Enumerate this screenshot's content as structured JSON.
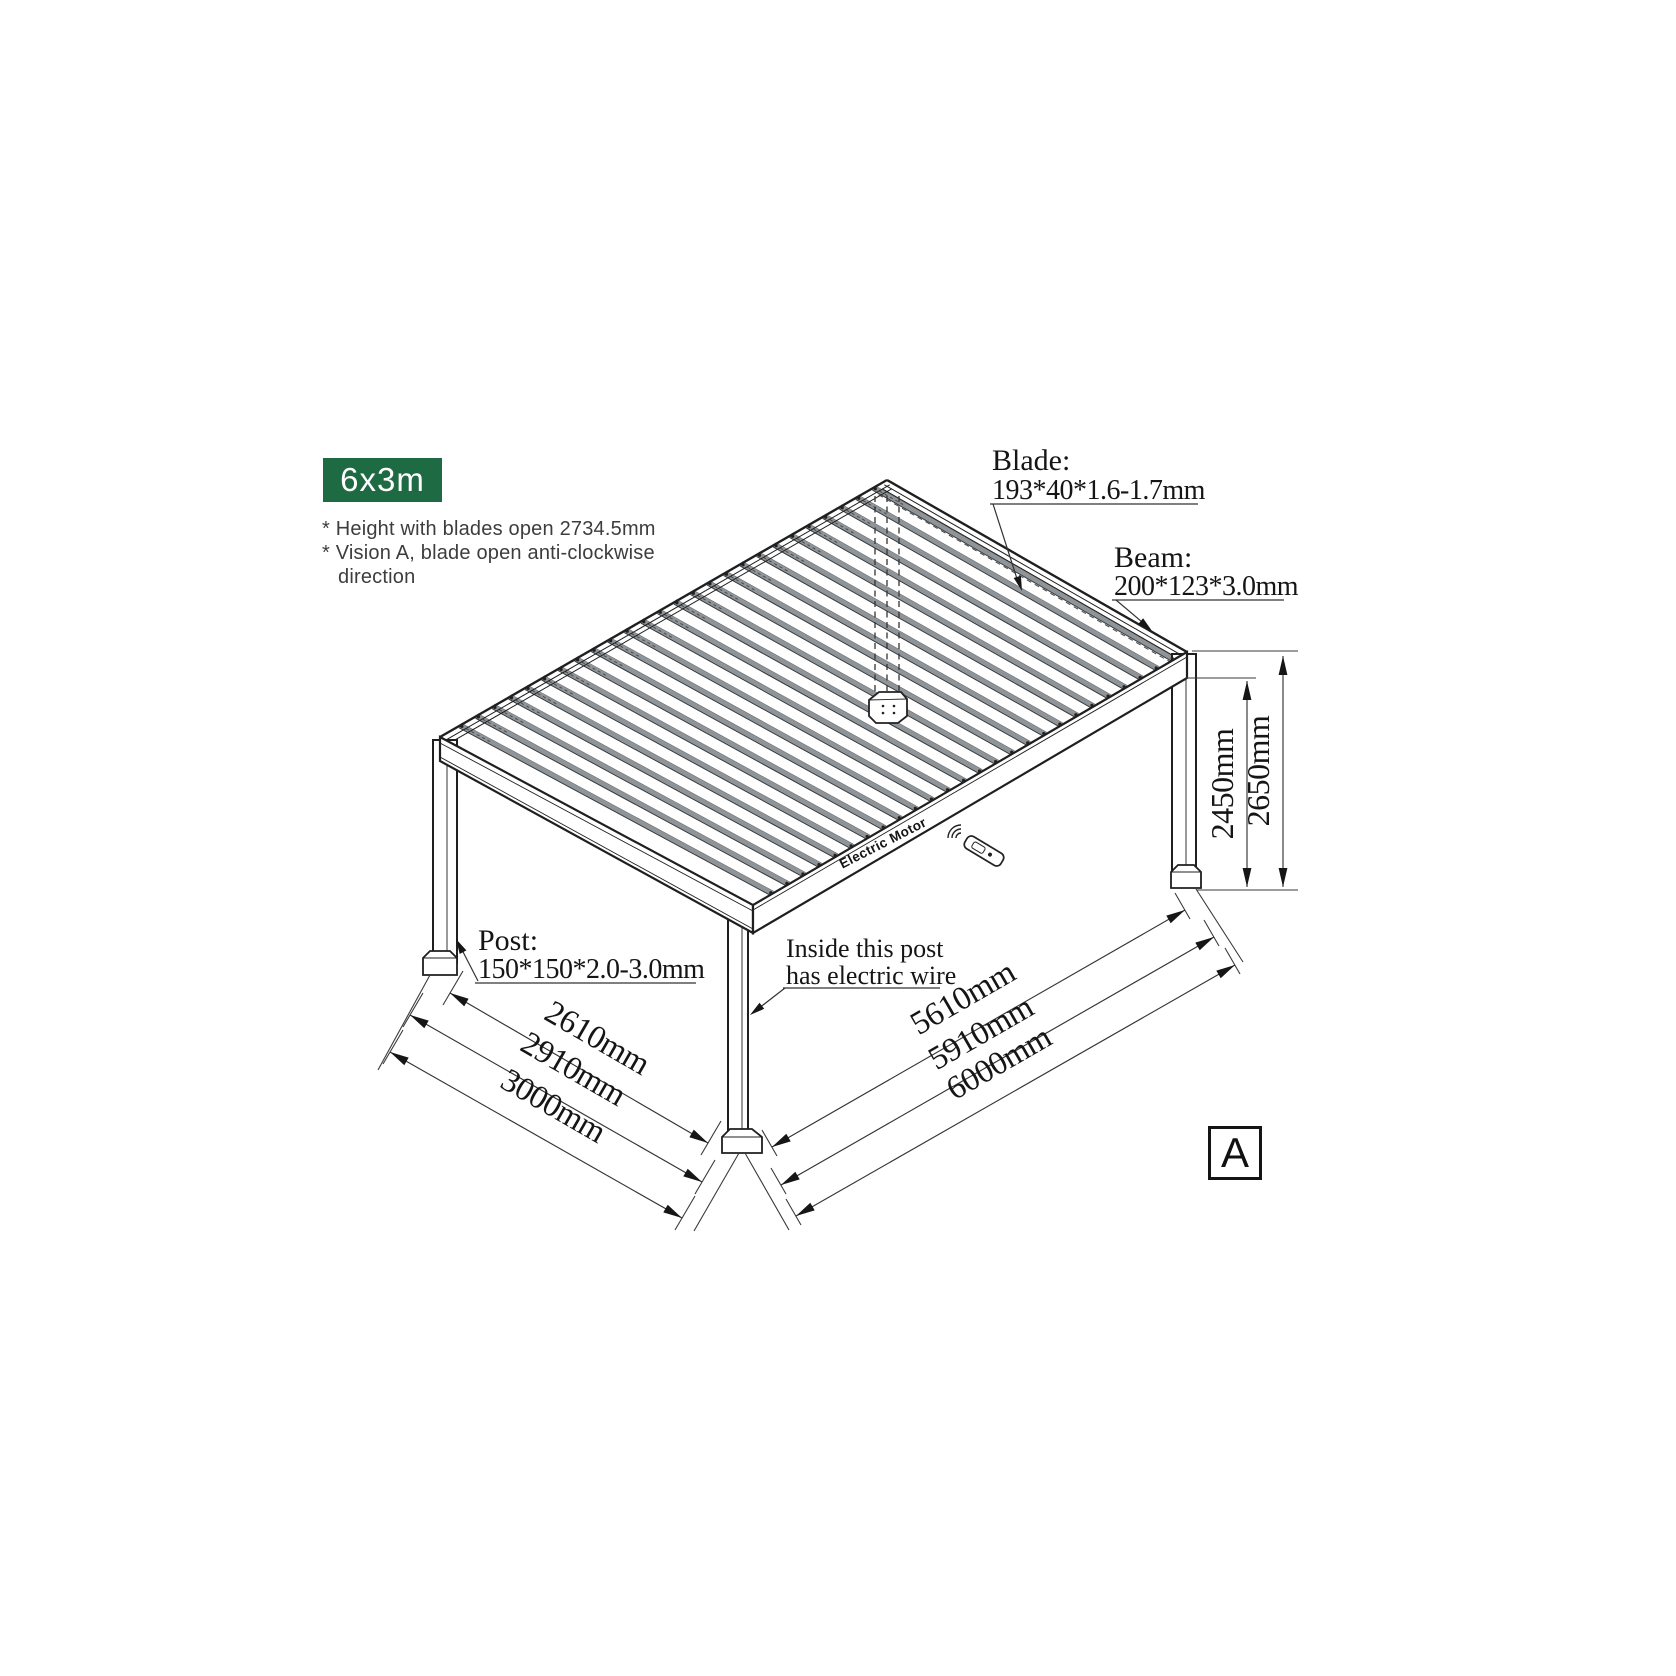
{
  "badge": {
    "label": "6x3m"
  },
  "notes": {
    "line1": "* Height with blades open 2734.5mm",
    "line2": "* Vision A, blade open anti-clockwise",
    "line3": "direction"
  },
  "callouts": {
    "blade": {
      "title": "Blade:",
      "value": "193*40*1.6-1.7mm"
    },
    "beam": {
      "title": "Beam:",
      "value": "200*123*3.0mm"
    },
    "post": {
      "title": "Post:",
      "value": "150*150*2.0-3.0mm"
    },
    "wire": {
      "line1": "Inside this post",
      "line2": "has electric wire"
    }
  },
  "dimensions": {
    "height_to_beam": "2450mm",
    "height_total": "2650mm",
    "depth_inner": "2610mm",
    "depth_mid": "2910mm",
    "depth_total": "3000mm",
    "length_inner": "5610mm",
    "length_mid": "5910mm",
    "length_total": "6000mm"
  },
  "motor_label": "Electric Motor",
  "view_marker": "A",
  "colors": {
    "badge_bg": "#1e6a43",
    "line": "#1f1f1f",
    "louver_gray": "#8f9498",
    "note_text": "#3d3d3d"
  }
}
